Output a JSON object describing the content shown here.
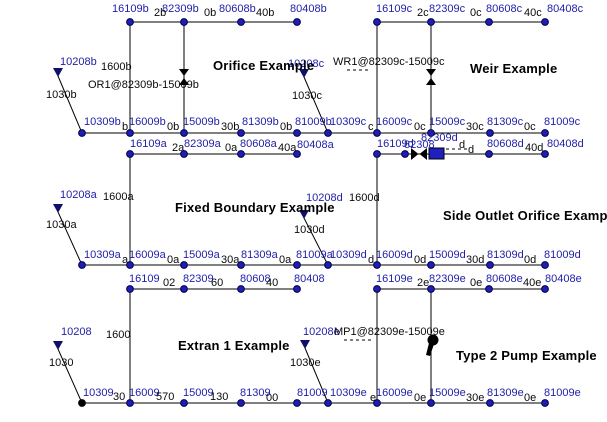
{
  "diagram": {
    "background": "#ffffff",
    "colors": {
      "node_fill": "#1e1eb4",
      "node_stroke": "#00004a",
      "outfall_node_fill": "#000000",
      "node_label": "#2121a8",
      "conduit_label": "#0a0a0a",
      "line": "#000000",
      "gate_fill": "#2020c0",
      "symbol": "#000000"
    },
    "titles": [
      {
        "text": "Orifice Example",
        "x": 213,
        "y": 59
      },
      {
        "text": "Weir Example",
        "x": 470,
        "y": 62
      },
      {
        "text": "Fixed Boundary Example",
        "x": 175,
        "y": 201
      },
      {
        "text": "Side Outlet Orifice Example",
        "x": 443,
        "y": 209
      },
      {
        "text": "Extran 1 Example",
        "x": 178,
        "y": 339
      },
      {
        "text": "Type 2 Pump Example",
        "x": 456,
        "y": 349
      }
    ],
    "node_labels": [
      {
        "text": "16109b",
        "x": 112,
        "y": 4
      },
      {
        "text": "82309b",
        "x": 162,
        "y": 4
      },
      {
        "text": "80608b",
        "x": 219,
        "y": 4
      },
      {
        "text": "80408b",
        "x": 290,
        "y": 4
      },
      {
        "text": "16109c",
        "x": 376,
        "y": 4
      },
      {
        "text": "82309c",
        "x": 429,
        "y": 4
      },
      {
        "text": "80608c",
        "x": 486,
        "y": 4
      },
      {
        "text": "80408c",
        "x": 547,
        "y": 4
      },
      {
        "text": "10309b",
        "x": 84,
        "y": 117
      },
      {
        "text": "16009b",
        "x": 129,
        "y": 117
      },
      {
        "text": "15009b",
        "x": 183,
        "y": 117
      },
      {
        "text": "81309b",
        "x": 242,
        "y": 117
      },
      {
        "text": "81009b",
        "x": 295,
        "y": 117
      },
      {
        "text": "10309c",
        "x": 330,
        "y": 117
      },
      {
        "text": "16009c",
        "x": 376,
        "y": 117
      },
      {
        "text": "15009c",
        "x": 429,
        "y": 117
      },
      {
        "text": "81309c",
        "x": 487,
        "y": 117
      },
      {
        "text": "81009c",
        "x": 544,
        "y": 117
      },
      {
        "text": "16109a",
        "x": 130,
        "y": 139
      },
      {
        "text": "82309a",
        "x": 184,
        "y": 139
      },
      {
        "text": "80608a",
        "x": 240,
        "y": 139
      },
      {
        "text": "80408a",
        "x": 297,
        "y": 140
      },
      {
        "text": "16109d",
        "x": 377,
        "y": 139
      },
      {
        "text": "82308",
        "x": 404,
        "y": 140
      },
      {
        "text": "82309d",
        "x": 421,
        "y": 133
      },
      {
        "text": "80608d",
        "x": 487,
        "y": 139
      },
      {
        "text": "80408d",
        "x": 547,
        "y": 139
      },
      {
        "text": "10309a",
        "x": 84,
        "y": 250
      },
      {
        "text": "16009a",
        "x": 129,
        "y": 250
      },
      {
        "text": "15009a",
        "x": 183,
        "y": 250
      },
      {
        "text": "81309a",
        "x": 241,
        "y": 250
      },
      {
        "text": "81009a",
        "x": 296,
        "y": 250
      },
      {
        "text": "10309d",
        "x": 330,
        "y": 250
      },
      {
        "text": "16009d",
        "x": 376,
        "y": 250
      },
      {
        "text": "15009d",
        "x": 429,
        "y": 250
      },
      {
        "text": "81309d",
        "x": 487,
        "y": 250
      },
      {
        "text": "81009d",
        "x": 544,
        "y": 250
      },
      {
        "text": "16109",
        "x": 129,
        "y": 274
      },
      {
        "text": "82309",
        "x": 183,
        "y": 274
      },
      {
        "text": "80608",
        "x": 240,
        "y": 274
      },
      {
        "text": "80408",
        "x": 294,
        "y": 274
      },
      {
        "text": "16109e",
        "x": 376,
        "y": 274
      },
      {
        "text": "82309e",
        "x": 429,
        "y": 274
      },
      {
        "text": "80608e",
        "x": 486,
        "y": 274
      },
      {
        "text": "80408e",
        "x": 545,
        "y": 274
      },
      {
        "text": "10309",
        "x": 83,
        "y": 388
      },
      {
        "text": "16009",
        "x": 129,
        "y": 388
      },
      {
        "text": "15009",
        "x": 183,
        "y": 388
      },
      {
        "text": "81309",
        "x": 240,
        "y": 388
      },
      {
        "text": "81009",
        "x": 297,
        "y": 388
      },
      {
        "text": "10309e",
        "x": 330,
        "y": 388
      },
      {
        "text": "16009e",
        "x": 376,
        "y": 388
      },
      {
        "text": "15009e",
        "x": 429,
        "y": 388
      },
      {
        "text": "81309e",
        "x": 487,
        "y": 388
      },
      {
        "text": "81009e",
        "x": 544,
        "y": 388
      },
      {
        "text": "10208b",
        "x": 60,
        "y": 57
      },
      {
        "text": "10208c",
        "x": 288,
        "y": 59
      },
      {
        "text": "10208a",
        "x": 60,
        "y": 190
      },
      {
        "text": "10208d",
        "x": 306,
        "y": 193
      },
      {
        "text": "10208",
        "x": 61,
        "y": 327
      },
      {
        "text": "10208e",
        "x": 303,
        "y": 327
      }
    ],
    "conduit_labels": [
      {
        "text": "2b",
        "x": 154,
        "y": 8
      },
      {
        "text": "0b",
        "x": 204,
        "y": 8
      },
      {
        "text": "40b",
        "x": 256,
        "y": 8
      },
      {
        "text": "2c",
        "x": 417,
        "y": 8
      },
      {
        "text": "0c",
        "x": 470,
        "y": 8
      },
      {
        "text": "40c",
        "x": 524,
        "y": 8
      },
      {
        "text": "b",
        "x": 122,
        "y": 122
      },
      {
        "text": "0b",
        "x": 167,
        "y": 122
      },
      {
        "text": "30b",
        "x": 221,
        "y": 122
      },
      {
        "text": "0b",
        "x": 280,
        "y": 122
      },
      {
        "text": "c",
        "x": 368,
        "y": 122
      },
      {
        "text": "0c",
        "x": 414,
        "y": 122
      },
      {
        "text": "30c",
        "x": 466,
        "y": 122
      },
      {
        "text": "0c",
        "x": 524,
        "y": 122
      },
      {
        "text": "2a",
        "x": 172,
        "y": 143
      },
      {
        "text": "0a",
        "x": 225,
        "y": 143
      },
      {
        "text": "40a",
        "x": 278,
        "y": 143
      },
      {
        "text": "d",
        "x": 459,
        "y": 140
      },
      {
        "text": "d",
        "x": 468,
        "y": 145
      },
      {
        "text": "40d",
        "x": 525,
        "y": 143
      },
      {
        "text": "a",
        "x": 122,
        "y": 255
      },
      {
        "text": "0a",
        "x": 167,
        "y": 255
      },
      {
        "text": "30a",
        "x": 221,
        "y": 255
      },
      {
        "text": "0a",
        "x": 279,
        "y": 255
      },
      {
        "text": "d",
        "x": 368,
        "y": 255
      },
      {
        "text": "0d",
        "x": 414,
        "y": 255
      },
      {
        "text": "30d",
        "x": 466,
        "y": 255
      },
      {
        "text": "0d",
        "x": 524,
        "y": 255
      },
      {
        "text": "02",
        "x": 163,
        "y": 278
      },
      {
        "text": "60",
        "x": 211,
        "y": 278
      },
      {
        "text": "40",
        "x": 266,
        "y": 278
      },
      {
        "text": "2e",
        "x": 417,
        "y": 278
      },
      {
        "text": "0e",
        "x": 470,
        "y": 278
      },
      {
        "text": "40e",
        "x": 523,
        "y": 278
      },
      {
        "text": "30",
        "x": 113,
        "y": 392
      },
      {
        "text": "570",
        "x": 156,
        "y": 392
      },
      {
        "text": "130",
        "x": 210,
        "y": 392
      },
      {
        "text": "00",
        "x": 266,
        "y": 393
      },
      {
        "text": "e",
        "x": 370,
        "y": 393
      },
      {
        "text": "0e",
        "x": 414,
        "y": 393
      },
      {
        "text": "30e",
        "x": 466,
        "y": 393
      },
      {
        "text": "0e",
        "x": 524,
        "y": 393
      }
    ],
    "annotations": [
      {
        "text": "1600b",
        "x": 101,
        "y": 62
      },
      {
        "text": "OR1@82309b-15009b",
        "x": 88,
        "y": 80
      },
      {
        "text": "1030b",
        "x": 46,
        "y": 90
      },
      {
        "text": "WR1@82309c-15009c",
        "x": 333,
        "y": 57
      },
      {
        "text": "1030c",
        "x": 292,
        "y": 91
      },
      {
        "text": "1600a",
        "x": 103,
        "y": 192
      },
      {
        "text": "1030a",
        "x": 46,
        "y": 220
      },
      {
        "text": "1600d",
        "x": 349,
        "y": 193
      },
      {
        "text": "1030d",
        "x": 294,
        "y": 225
      },
      {
        "text": "1600",
        "x": 106,
        "y": 330
      },
      {
        "text": "1030",
        "x": 49,
        "y": 358
      },
      {
        "text": "MP1@82309e-15009e",
        "x": 334,
        "y": 327
      },
      {
        "text": "1030e",
        "x": 290,
        "y": 358
      }
    ],
    "edges": [
      {
        "x1": 130,
        "y1": 22,
        "x2": 297,
        "y2": 22
      },
      {
        "x1": 377,
        "y1": 22,
        "x2": 545,
        "y2": 22
      },
      {
        "x1": 82,
        "y1": 133,
        "x2": 545,
        "y2": 133
      },
      {
        "x1": 130,
        "y1": 154,
        "x2": 297,
        "y2": 154
      },
      {
        "x1": 377,
        "y1": 154,
        "x2": 545,
        "y2": 154
      },
      {
        "x1": 82,
        "y1": 265,
        "x2": 545,
        "y2": 265
      },
      {
        "x1": 130,
        "y1": 289,
        "x2": 297,
        "y2": 289
      },
      {
        "x1": 377,
        "y1": 289,
        "x2": 545,
        "y2": 289
      },
      {
        "x1": 82,
        "y1": 403,
        "x2": 545,
        "y2": 403
      },
      {
        "x1": 130,
        "y1": 22,
        "x2": 130,
        "y2": 133
      },
      {
        "x1": 184,
        "y1": 22,
        "x2": 184,
        "y2": 133
      },
      {
        "x1": 377,
        "y1": 22,
        "x2": 377,
        "y2": 133
      },
      {
        "x1": 431,
        "y1": 22,
        "x2": 431,
        "y2": 133
      },
      {
        "x1": 130,
        "y1": 154,
        "x2": 130,
        "y2": 265
      },
      {
        "x1": 377,
        "y1": 154,
        "x2": 377,
        "y2": 265
      },
      {
        "x1": 130,
        "y1": 289,
        "x2": 130,
        "y2": 403
      },
      {
        "x1": 377,
        "y1": 289,
        "x2": 377,
        "y2": 403
      },
      {
        "x1": 431,
        "y1": 289,
        "x2": 431,
        "y2": 403
      },
      {
        "x1": 58,
        "y1": 76,
        "x2": 82,
        "y2": 133
      },
      {
        "x1": 304,
        "y1": 77,
        "x2": 328,
        "y2": 133
      },
      {
        "x1": 58,
        "y1": 212,
        "x2": 82,
        "y2": 265
      },
      {
        "x1": 304,
        "y1": 218,
        "x2": 328,
        "y2": 265
      },
      {
        "x1": 58,
        "y1": 349,
        "x2": 82,
        "y2": 403
      },
      {
        "x1": 305,
        "y1": 348,
        "x2": 328,
        "y2": 403
      },
      {
        "x1": 347,
        "y1": 70,
        "x2": 368,
        "y2": 70,
        "dashed": true
      },
      {
        "x1": 446,
        "y1": 149,
        "x2": 470,
        "y2": 149,
        "dashed": true
      },
      {
        "x1": 344,
        "y1": 340,
        "x2": 372,
        "y2": 340,
        "dashed": true
      }
    ],
    "nodes": [
      {
        "x": 130,
        "y": 22
      },
      {
        "x": 184,
        "y": 22
      },
      {
        "x": 241,
        "y": 22
      },
      {
        "x": 297,
        "y": 22
      },
      {
        "x": 377,
        "y": 22
      },
      {
        "x": 431,
        "y": 22
      },
      {
        "x": 489,
        "y": 22
      },
      {
        "x": 545,
        "y": 22
      },
      {
        "x": 82,
        "y": 133
      },
      {
        "x": 130,
        "y": 133
      },
      {
        "x": 184,
        "y": 133
      },
      {
        "x": 241,
        "y": 133
      },
      {
        "x": 297,
        "y": 133
      },
      {
        "x": 328,
        "y": 133
      },
      {
        "x": 377,
        "y": 133
      },
      {
        "x": 431,
        "y": 133
      },
      {
        "x": 490,
        "y": 133
      },
      {
        "x": 545,
        "y": 133
      },
      {
        "x": 130,
        "y": 154
      },
      {
        "x": 184,
        "y": 154
      },
      {
        "x": 241,
        "y": 154
      },
      {
        "x": 297,
        "y": 154
      },
      {
        "x": 377,
        "y": 154
      },
      {
        "x": 405,
        "y": 154
      },
      {
        "x": 489,
        "y": 154
      },
      {
        "x": 545,
        "y": 154
      },
      {
        "x": 82,
        "y": 265
      },
      {
        "x": 130,
        "y": 265
      },
      {
        "x": 184,
        "y": 265
      },
      {
        "x": 241,
        "y": 265
      },
      {
        "x": 297,
        "y": 265
      },
      {
        "x": 328,
        "y": 265
      },
      {
        "x": 377,
        "y": 265
      },
      {
        "x": 431,
        "y": 265
      },
      {
        "x": 490,
        "y": 265
      },
      {
        "x": 545,
        "y": 265
      },
      {
        "x": 130,
        "y": 289
      },
      {
        "x": 184,
        "y": 289
      },
      {
        "x": 241,
        "y": 289
      },
      {
        "x": 297,
        "y": 289
      },
      {
        "x": 377,
        "y": 289
      },
      {
        "x": 431,
        "y": 289
      },
      {
        "x": 489,
        "y": 289
      },
      {
        "x": 545,
        "y": 289
      },
      {
        "x": 82,
        "y": 403,
        "outfall": true
      },
      {
        "x": 130,
        "y": 403
      },
      {
        "x": 184,
        "y": 403
      },
      {
        "x": 241,
        "y": 403
      },
      {
        "x": 297,
        "y": 403
      },
      {
        "x": 328,
        "y": 403
      },
      {
        "x": 377,
        "y": 403
      },
      {
        "x": 431,
        "y": 403
      },
      {
        "x": 490,
        "y": 403
      },
      {
        "x": 545,
        "y": 403
      }
    ],
    "symbols": {
      "boundary_triangles": [
        {
          "x": 58,
          "y": 72
        },
        {
          "x": 304,
          "y": 73
        },
        {
          "x": 58,
          "y": 208
        },
        {
          "x": 304,
          "y": 214
        },
        {
          "x": 58,
          "y": 345
        },
        {
          "x": 305,
          "y": 344
        }
      ],
      "orifice_bowtie": {
        "x": 184,
        "y": 77
      },
      "weir_bowtie": {
        "x": 431,
        "y": 77
      },
      "side_outlet_bowtie": {
        "x": 419,
        "y": 154
      },
      "gate_rect": {
        "x": 429,
        "y": 148,
        "w": 15,
        "h": 11
      },
      "pump": {
        "x": 433,
        "y": 340
      }
    }
  }
}
